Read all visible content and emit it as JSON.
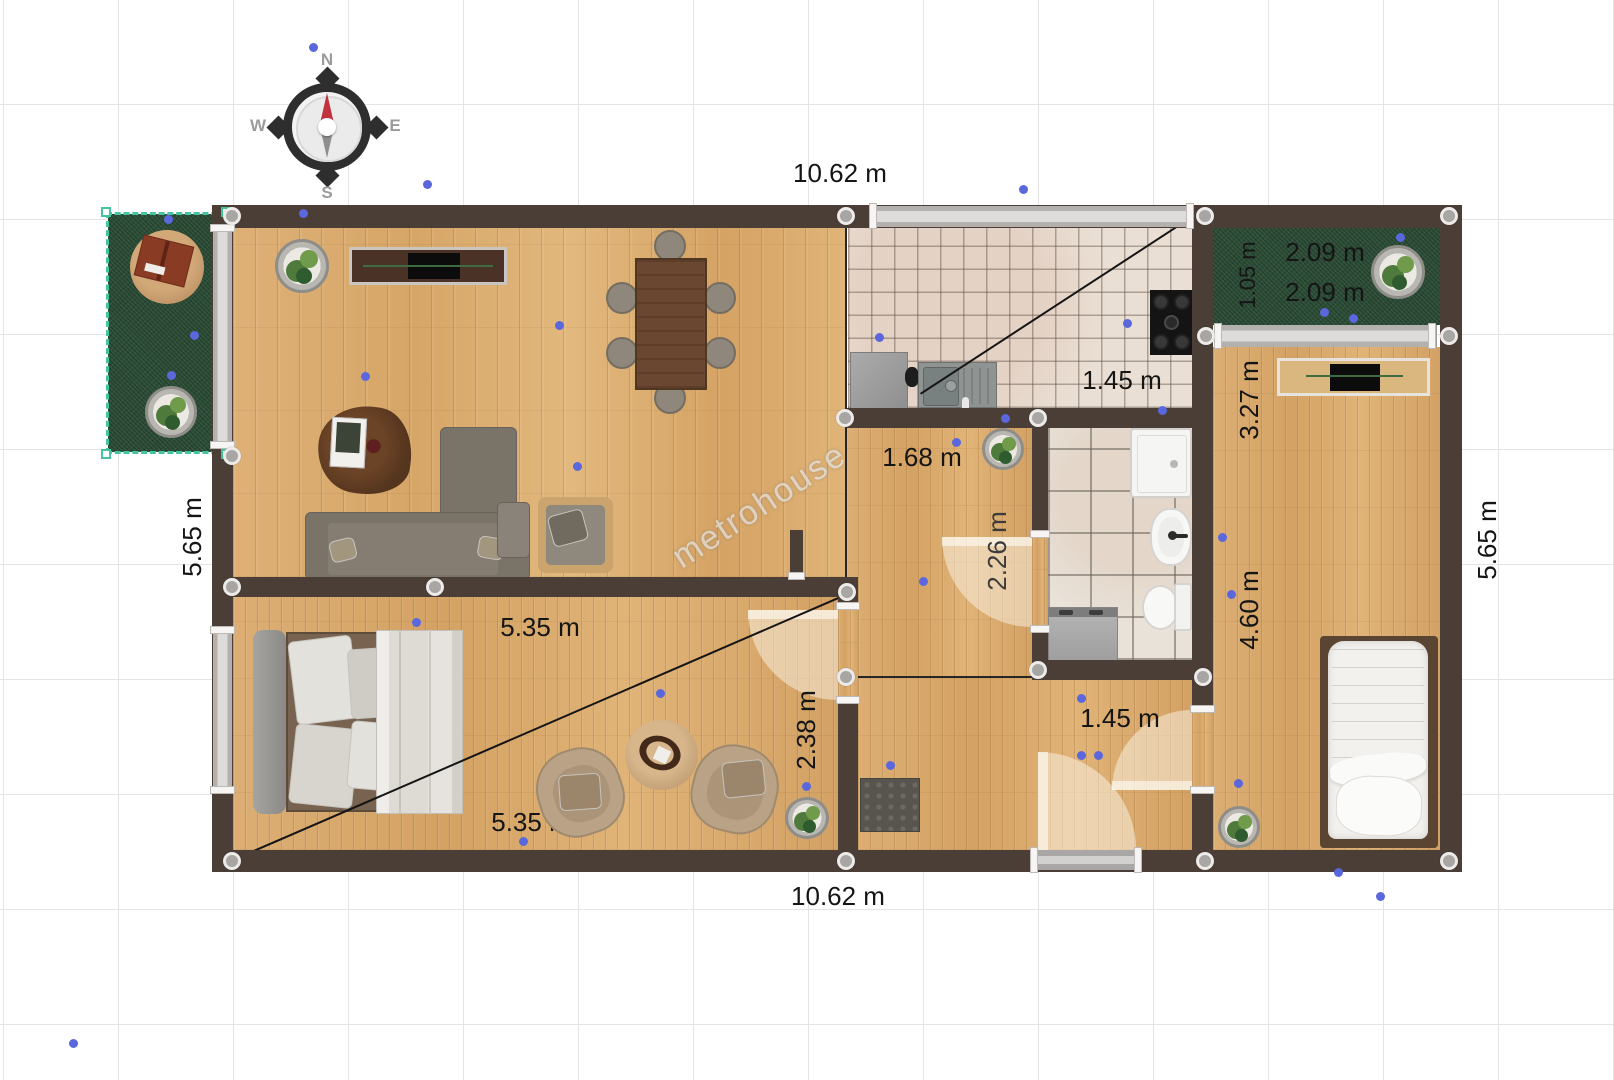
{
  "watermark": "metrohouse",
  "compass": {
    "north": "N",
    "east": "E",
    "south": "S",
    "west": "W"
  },
  "dimensions": {
    "top_width": "10.62 m",
    "bottom_width": "10.62 m",
    "left_height": "5.65 m",
    "right_height": "5.65 m",
    "terrace_width_a": "2.09 m",
    "terrace_width_b": "2.09 m",
    "terrace_depth": "1.05 m",
    "kitchen_width": "1.45 m",
    "kitchen_partial": "0",
    "hall_width": "1.68 m",
    "bathroom_door": "2.26 m",
    "bedroom2_upper": "3.27 m",
    "bedroom2_lower": "4.60 m",
    "bedroom1_width": "5.35 m",
    "bedroom1_width_b": "5.35 m",
    "bedroom1_depth": "2.38 m",
    "entry_width": "1.45 m"
  },
  "colors": {
    "wall": "#4a3e36",
    "floor_wood": "#dcae72",
    "kitchen_tile": "#eadfd4",
    "bath_tile": "#e9e2d8",
    "grass": "#2e4f38",
    "selection_teal": "#45c4a0",
    "marker_blue": "#5b67dd",
    "control_gray": "#a8a6a3",
    "compass_needle_red": "#c2313e"
  },
  "points": {
    "control": [
      [
        232,
        216
      ],
      [
        846,
        216
      ],
      [
        1205,
        216
      ],
      [
        1449,
        216
      ],
      [
        232,
        456
      ],
      [
        1206,
        336
      ],
      [
        1449,
        336
      ],
      [
        232,
        587
      ],
      [
        435,
        587
      ],
      [
        847,
        592
      ],
      [
        845,
        418
      ],
      [
        1038,
        418
      ],
      [
        846,
        677
      ],
      [
        1038,
        670
      ],
      [
        1203,
        677
      ],
      [
        232,
        861
      ],
      [
        846,
        861
      ],
      [
        1205,
        861
      ],
      [
        1449,
        861
      ]
    ],
    "markers": [
      [
        313,
        47
      ],
      [
        427,
        184
      ],
      [
        303,
        213
      ],
      [
        1023,
        189
      ],
      [
        879,
        337
      ],
      [
        1127,
        323
      ],
      [
        1400,
        237
      ],
      [
        1324,
        312
      ],
      [
        1353,
        318
      ],
      [
        168,
        219
      ],
      [
        194,
        335
      ],
      [
        171,
        375
      ],
      [
        559,
        325
      ],
      [
        365,
        376
      ],
      [
        577,
        466
      ],
      [
        956,
        442
      ],
      [
        1005,
        418
      ],
      [
        923,
        581
      ],
      [
        1162,
        410
      ],
      [
        1222,
        537
      ],
      [
        1231,
        594
      ],
      [
        1238,
        783
      ],
      [
        416,
        622
      ],
      [
        523,
        841
      ],
      [
        660,
        693
      ],
      [
        806,
        786
      ],
      [
        1081,
        698
      ],
      [
        1081,
        755
      ],
      [
        1098,
        755
      ],
      [
        890,
        765
      ],
      [
        73,
        1043
      ],
      [
        1338,
        872
      ],
      [
        1380,
        896
      ]
    ]
  }
}
